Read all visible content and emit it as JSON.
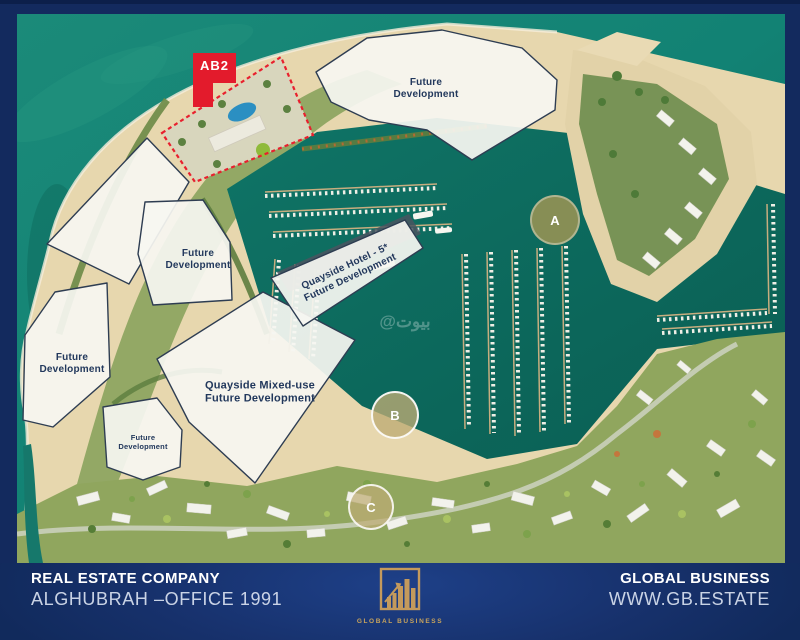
{
  "colors": {
    "accent_red": "#e31b2c",
    "gold": "#c9a45c",
    "navy": "#132a5e",
    "sea_teal": "#12796c",
    "marker_olive": "#878e55",
    "marker_tan": "#bfa877"
  },
  "map": {
    "ab2_label": "AB2",
    "labels": {
      "north": {
        "line1": "Future",
        "line2": "Development"
      },
      "mid": {
        "line1": "Future",
        "line2": "Development"
      },
      "west": {
        "line1": "Future",
        "line2": "Development"
      },
      "small": {
        "line1": "Future",
        "line2": "Development"
      },
      "mixed_use": {
        "line1": "Quayside Mixed-use",
        "line2": "Future Development"
      },
      "hotel": {
        "line1": "Quayside Hotel - 5*",
        "line2": "Future Development"
      }
    },
    "markers": {
      "a": "A",
      "b": "B",
      "c": "C"
    },
    "watermark": "@بيوت"
  },
  "footer": {
    "company": {
      "title": "REAL ESTATE COMPANY",
      "subtitle": "ALGHUBRAH –OFFICE 1991"
    },
    "brand": {
      "title": "GLOBAL BUSINESS",
      "website": "WWW.GB.ESTATE"
    },
    "logo": {
      "text": "GLOBAL BUSINESS"
    }
  }
}
